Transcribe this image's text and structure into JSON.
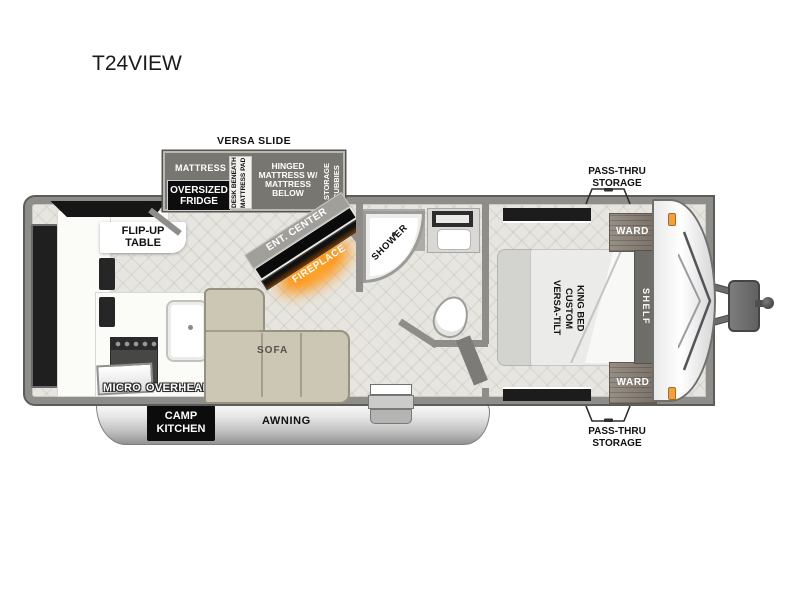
{
  "title": "T24VIEW",
  "colors": {
    "fireplace_glow": "#ff9d2e",
    "marker_light": "#f0a13c",
    "slide_fill": "#787670",
    "sofa_fill": "#ccc6b4"
  },
  "slide": {
    "label": "VERSA SLIDE",
    "mattress": "MATTRESS",
    "fridge": "OVERSIZED FRIDGE",
    "desk": "DESK BENEATH MATTRESS PAD",
    "hinged": "HINGED MATTRESS W/ MATTRESS BELOW",
    "cubbies": "STORAGE CUBBIES"
  },
  "living": {
    "flip_table": "FLIP-UP TABLE",
    "ent_center": "ENT. CENTER",
    "fireplace": "FIREPLACE",
    "sofa": "SOFA",
    "micro": "MICRO",
    "overhead": "OVERHEAD"
  },
  "bath": {
    "shower": "SHOWER"
  },
  "bedroom": {
    "bed": "VERSA-TILT CUSTOM KING BED",
    "ward_top": "WARD",
    "ward_bottom": "WARD",
    "shelf": "SHELF"
  },
  "exterior": {
    "pass_thru_top": "PASS-THRU STORAGE",
    "pass_thru_bottom": "PASS-THRU STORAGE",
    "camp_kitchen": "CAMP KITCHEN",
    "awning": "AWNING"
  }
}
